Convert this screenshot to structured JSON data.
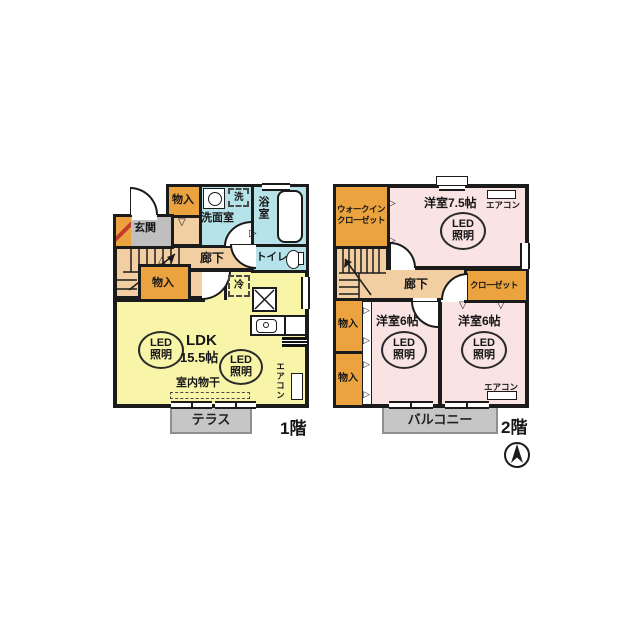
{
  "colors": {
    "wall": "#1b1b1b",
    "storage_orange": "#eaa33e",
    "hallway_tan": "#f2cfa2",
    "water_cyan": "#b5e3e9",
    "ldk_yellow": "#f8f5a9",
    "bedroom_pink": "#fae3e3",
    "outdoor_gray": "#c6c6c7",
    "entrance_gray": "#bfbfbf"
  },
  "floor1": {
    "floor_label": "1階",
    "labels": {
      "storage_top": "物入",
      "washer": "洗",
      "washroom": "洗面室",
      "bathroom": "浴室",
      "entrance": "玄関",
      "hallway": "廊下",
      "toilet": "トイレ",
      "storage_bottom": "物入",
      "fridge": "冷",
      "ldk_name": "LDK",
      "ldk_size": "15.5帖",
      "indoor_drying": "室内物干",
      "aircon": "エアコン",
      "terrace": "テラス"
    }
  },
  "floor2": {
    "floor_label": "2階",
    "labels": {
      "walkin_line1": "ウォークイン",
      "walkin_line2": "クローゼット",
      "bedroom75": "洋室7.5帖",
      "aircon_75": "エアコン",
      "hallway": "廊下",
      "closet": "クローゼット",
      "storage_upper": "物入",
      "storage_lower": "物入",
      "bedroom6_left": "洋室6帖",
      "bedroom6_right": "洋室6帖",
      "aircon_6r": "エアコン",
      "balcony": "バルコニー"
    }
  },
  "led_light": {
    "line1": "LED",
    "line2": "照明"
  },
  "icons": {
    "compass": "north-arrow"
  }
}
